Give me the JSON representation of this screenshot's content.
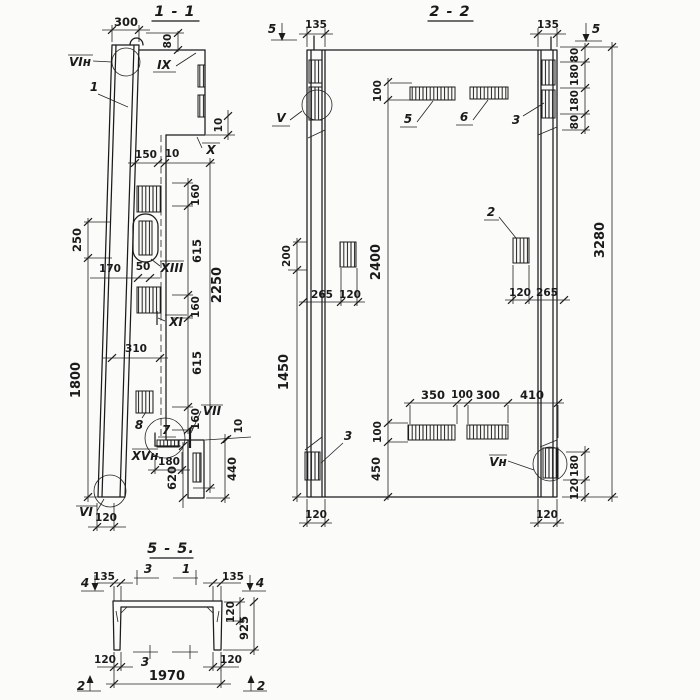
{
  "drawing": {
    "s11": {
      "title": "1 - 1",
      "labels": {
        "vi_n": "VIн",
        "one": "1",
        "ix": "IX",
        "x": "X",
        "xiii": "XIII",
        "xi": "XI",
        "eight": "8",
        "seven": "7",
        "vii": "VII",
        "xv_n": "XVн",
        "vi": "VI"
      },
      "dims": {
        "d300": "300",
        "d80": "80",
        "d150": "150",
        "d10": "10",
        "d160": "160",
        "d615": "615",
        "d2250": "2250",
        "d250": "250",
        "d1800": "1800",
        "d170": "170",
        "d50": "50",
        "d310": "310",
        "d180": "180",
        "d620": "620",
        "d440": "440",
        "d120": "120"
      }
    },
    "s22": {
      "title": "2 - 2",
      "labels": {
        "cut5": "5",
        "v": "V",
        "item2": "2",
        "item3": "3",
        "item5": "5",
        "item6": "6",
        "v_n": "Vн"
      },
      "dims": {
        "d135": "135",
        "d100": "100",
        "d80": "80",
        "d180": "180",
        "d200": "200",
        "d1450": "1450",
        "d2400": "2400",
        "d265": "265",
        "d120": "120",
        "d350": "350",
        "d300": "300",
        "d410": "410",
        "d450": "450",
        "d3280": "3280"
      }
    },
    "s55": {
      "title": "5 - 5.",
      "labels": {
        "cut4": "4",
        "cut3": "3",
        "cut1": "1",
        "cut2": "2"
      },
      "dims": {
        "d135": "135",
        "d120": "120",
        "d925": "925",
        "d1970": "1970"
      }
    }
  }
}
